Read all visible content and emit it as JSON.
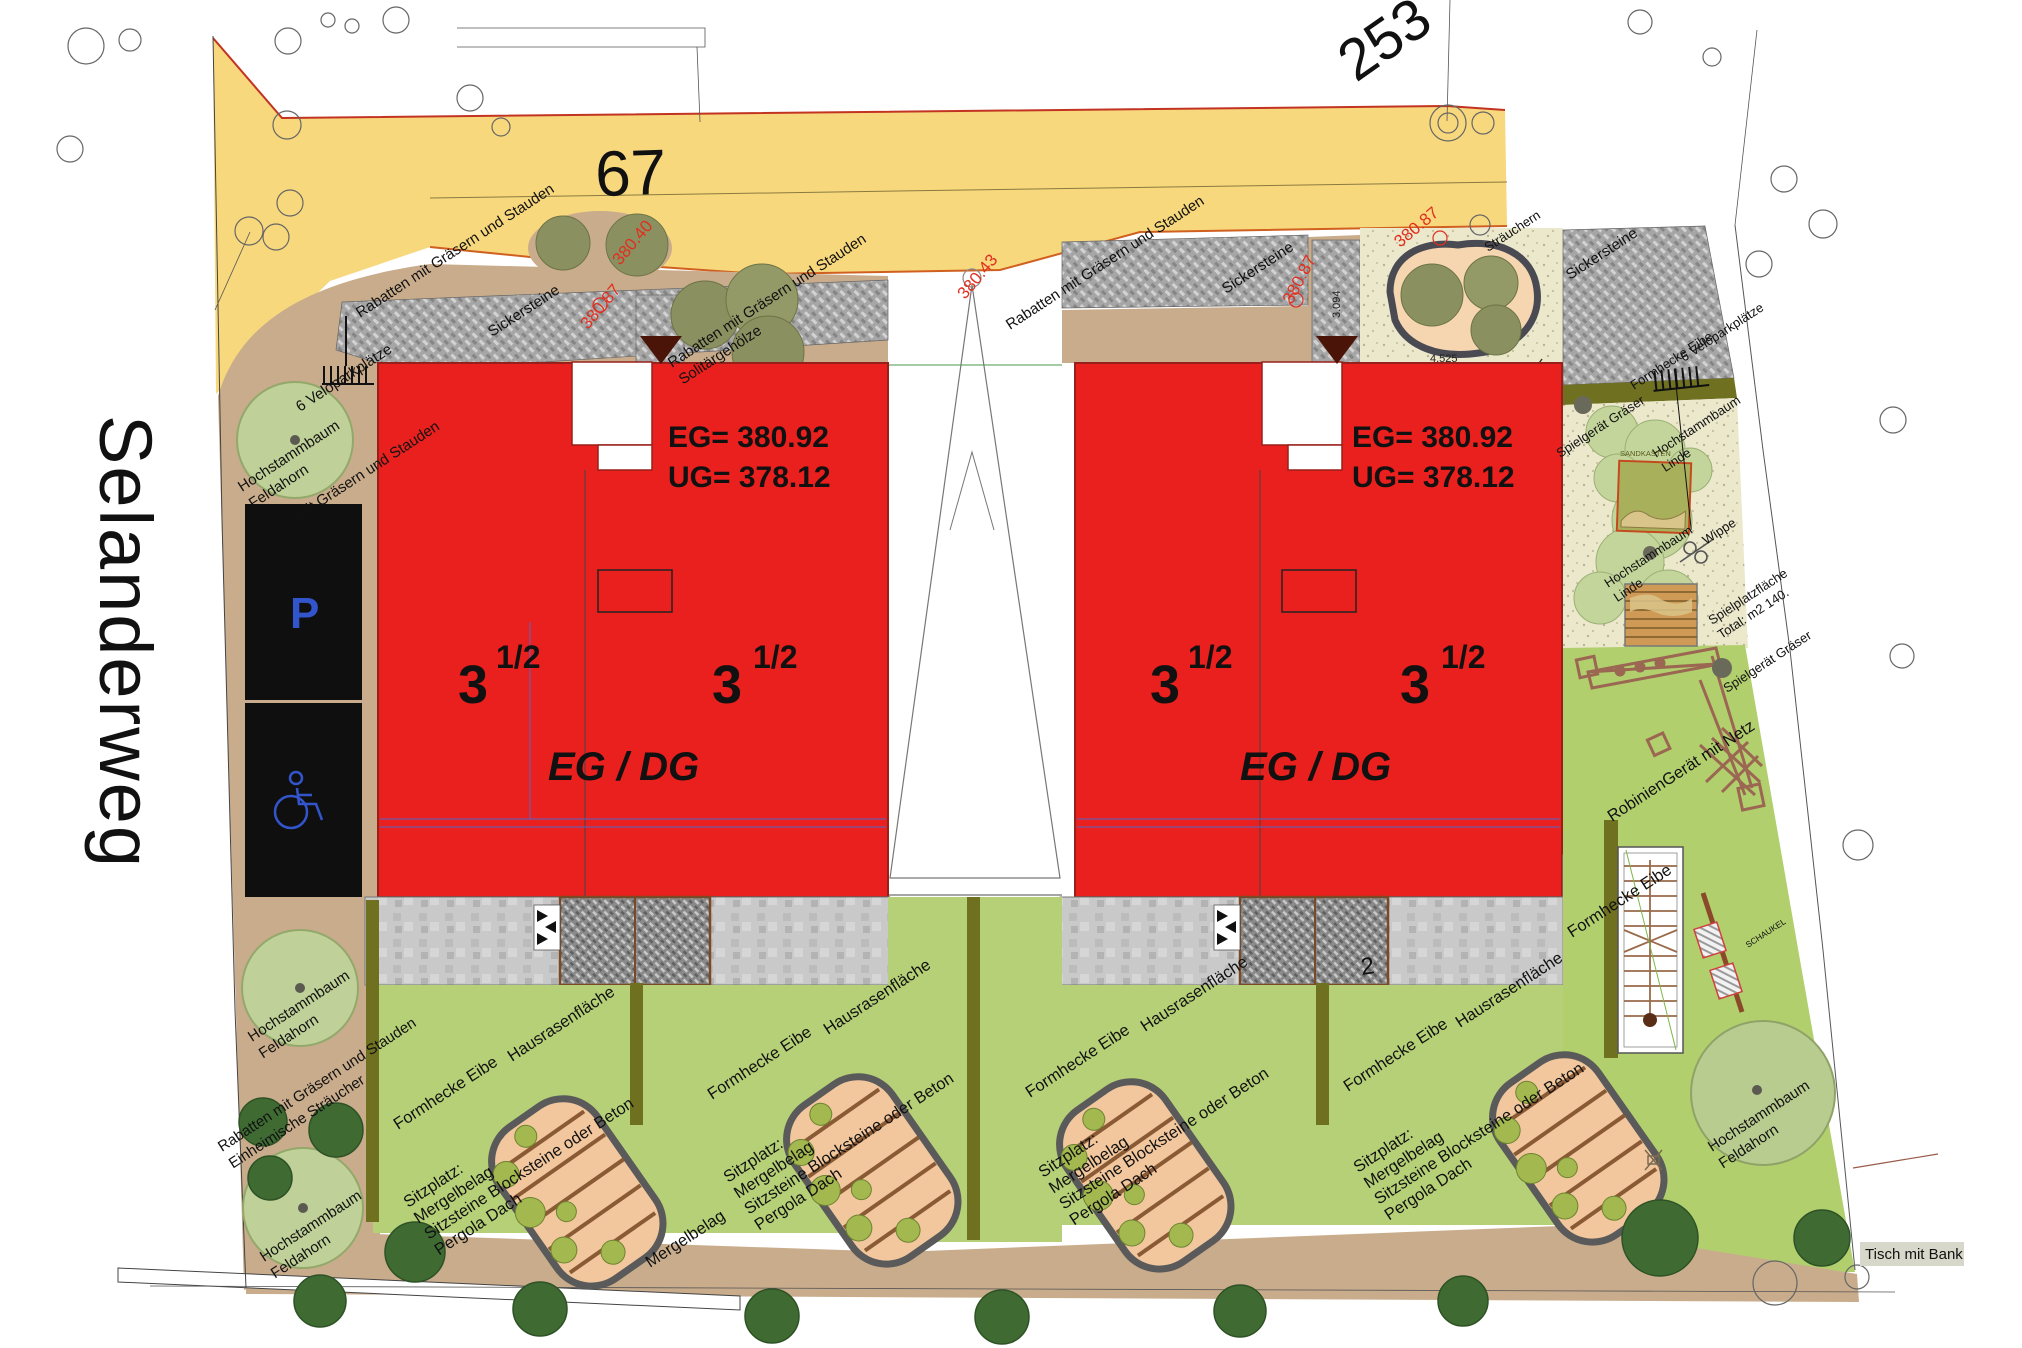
{
  "plan": {
    "street_name": "Selanderweg",
    "road_number": "67",
    "parcel_number": "253",
    "parking_sign": "P",
    "building": {
      "floors": "3",
      "floors_frac": "1/2",
      "levels": "EG / DG",
      "eg_level": "EG= 380.92",
      "ug_level": "UG= 378.12"
    },
    "elevations": {
      "a": "380.40",
      "b": "380.87",
      "c": "380.43"
    },
    "dimensions": {
      "bed_width": "4.525",
      "strip_width": "3.094",
      "num": "2"
    },
    "labels": {
      "rabatten": "Rabatten mit Gräsern und Stauden",
      "rabatten_partial": "mit Gräsern und Stauden",
      "einheimische": "Einheimische Sträucher",
      "solitaer": "Solitärgehölze",
      "sicker": "Sickersteine",
      "velo": "6 Veloparkplätze",
      "hochstamm": "Hochstammbaum",
      "feldahorn": "Feldahorn",
      "linde": "Linde",
      "formhecke": "Formhecke Eibe",
      "hausrasen": "Hausrasenfläche",
      "sitzplatz": "Sitzplatz:",
      "mergelbelag": "Mergelbelag",
      "sitzsteine": "Sitzsteine Blocksteine oder Beton",
      "pergola": "Pergola Dach",
      "spielgeraet": "Spielgerät Gräser",
      "sandkasten": "SANDKASTEN",
      "wippe": "Wippe",
      "spielplatz1": "Spielplatzfläche",
      "spielplatz2": "Total: m2 140.",
      "robinien": "RobinienGerät mit Netz",
      "schaukel": "SCHAUKEL",
      "tisch": "Tisch mit Bank",
      "straeuchern": "Sträuchern"
    },
    "colors": {
      "building_red": "#e9201d",
      "road_yellow": "#f8d87d",
      "lawn_green": "#b6d077",
      "sand_beige": "#ebe8cc",
      "earth_tan": "#c9ac8b",
      "hedge_olive": "#6f7020",
      "parking_black": "#0f0f0f",
      "accent_blue": "#3355cc",
      "elevation_red": "#e03020"
    }
  }
}
